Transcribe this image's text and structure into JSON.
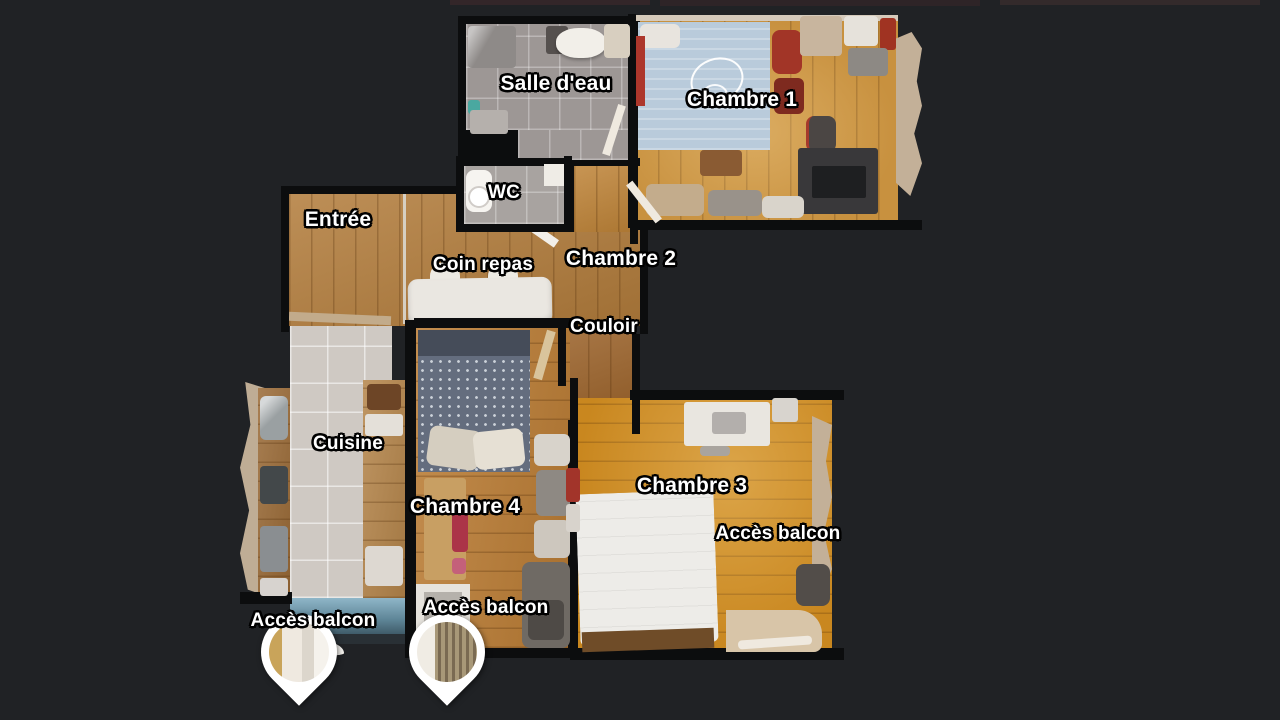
{
  "scene": {
    "type": "apartment-floorplan-top-view",
    "background_color": "#202225",
    "wall_color": "#0c0d0e",
    "label_text_color": "#ffffff",
    "label_outline_color": "#000000"
  },
  "rooms": [
    {
      "id": "salle-deau",
      "label": "Salle d'eau"
    },
    {
      "id": "chambre-1",
      "label": "Chambre 1"
    },
    {
      "id": "wc",
      "label": "WC"
    },
    {
      "id": "entree",
      "label": "Entrée"
    },
    {
      "id": "coin-repas",
      "label": "Coin repas"
    },
    {
      "id": "chambre-2",
      "label": "Chambre 2"
    },
    {
      "id": "couloir",
      "label": "Couloir"
    },
    {
      "id": "cuisine",
      "label": "Cuisine"
    },
    {
      "id": "chambre-4",
      "label": "Chambre 4"
    },
    {
      "id": "chambre-3",
      "label": "Chambre 3"
    }
  ],
  "balcony_access": [
    {
      "id": "acces-balcon-cuisine",
      "label": "Accès balcon"
    },
    {
      "id": "acces-balcon-chambre4",
      "label": "Accès balcon"
    },
    {
      "id": "acces-balcon-chambre3",
      "label": "Accès balcon"
    }
  ],
  "markers": [
    {
      "id": "pin-balcon-cuisine",
      "type": "balcony-photo-pin",
      "color": "#ffffff"
    },
    {
      "id": "pin-balcon-chambre4",
      "type": "balcony-photo-pin",
      "color": "#ffffff"
    }
  ]
}
